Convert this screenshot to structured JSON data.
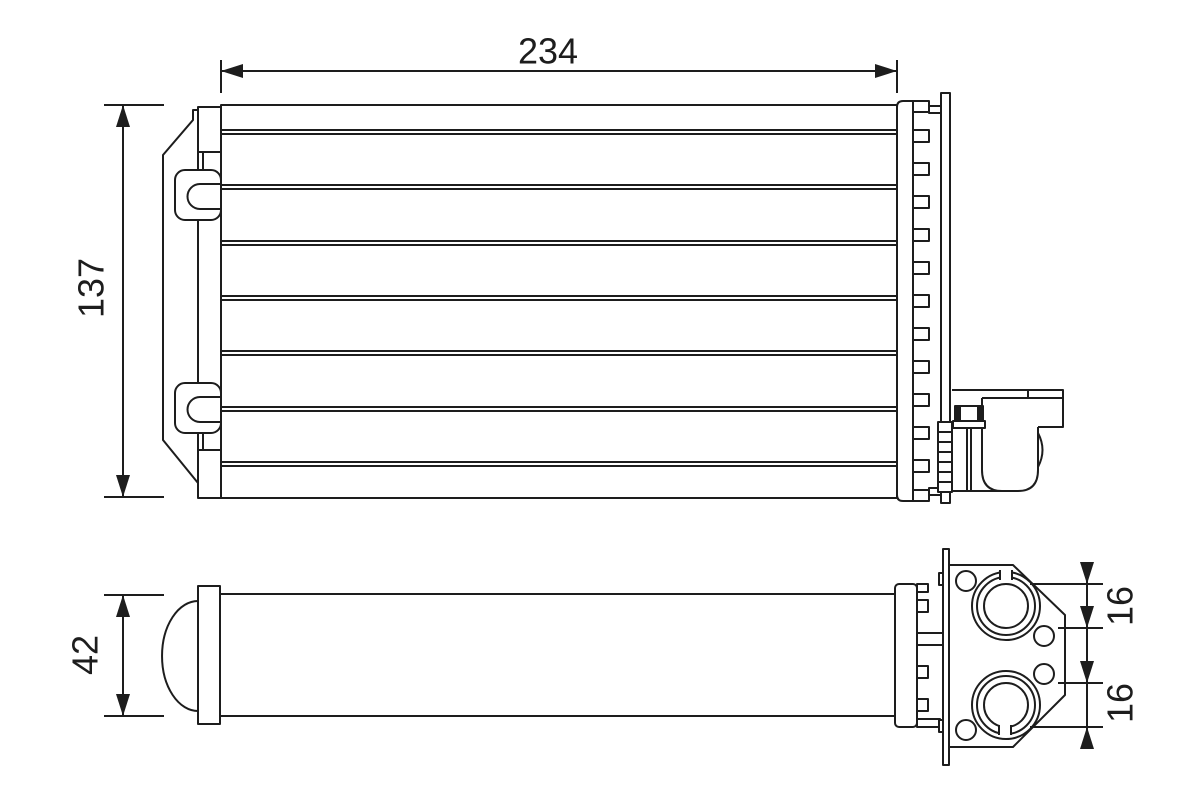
{
  "page": {
    "background_color": "#ffffff",
    "line_color": "#1d1d1d",
    "content": "engineering-drawing-two-views-heat-exchanger"
  },
  "dimensions": {
    "core_width": "234",
    "core_height": "137",
    "core_depth": "42",
    "port_upper_offset": "16",
    "port_lower_offset": "16"
  }
}
